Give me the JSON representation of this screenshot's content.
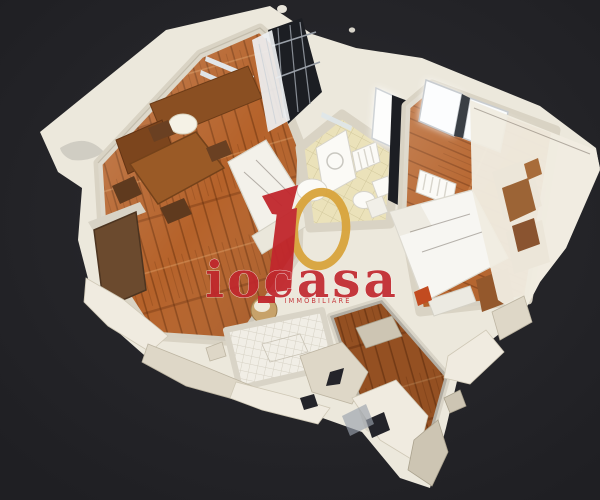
{
  "scene": {
    "viewer": "3d-dollhouse",
    "subject": "apartment-floorplan-scan",
    "rooms": [
      "living-dining-room",
      "bathroom",
      "bedroom",
      "hallway",
      "balcony"
    ]
  },
  "watermark": {
    "brand": "iocasa",
    "tagline": "IMMOBILIARE"
  },
  "colors": {
    "bg": "#232327",
    "bg_center": "#2b2b30",
    "wall": "#ece8dc",
    "wall_shade": "#d7d1c2",
    "wood": "#b5622a",
    "wood_dark": "#8a4318",
    "furniture_wood": "#8a4f22",
    "tile_bath": "#ebe2ba",
    "tile_white": "#f1eee6",
    "dark_gap": "#1c1e23",
    "brand": "#c1272d",
    "gold": "#d9a43c"
  }
}
